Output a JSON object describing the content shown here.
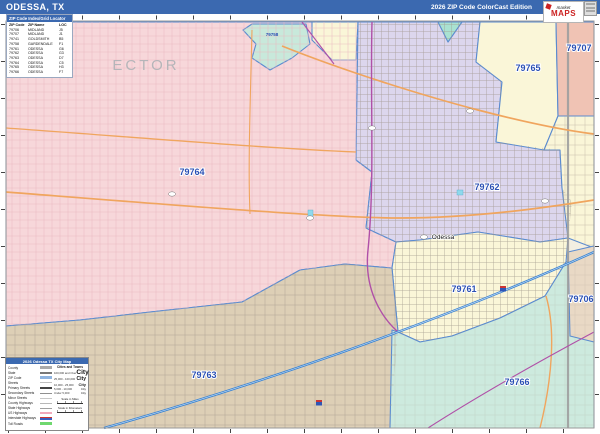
{
  "header": {
    "title": "ODESSA, TX",
    "edition": "2026 ZIP Code ColorCast Edition",
    "brand_top": "market",
    "brand_name": "MAPS"
  },
  "zip_index": {
    "title": "ZIP Code Index/Grid Locator",
    "columns": [
      "ZIP Code",
      "ZIP Name",
      "LOC"
    ],
    "rows": [
      [
        "79706",
        "MIDLAND",
        "J5"
      ],
      [
        "79707",
        "MIDLAND",
        "J1"
      ],
      [
        "79741",
        "GOLDSMITH",
        "B5"
      ],
      [
        "79758",
        "GARDENDALE",
        "F1"
      ],
      [
        "79761",
        "ODESSA",
        "G6"
      ],
      [
        "79762",
        "ODESSA",
        "G3"
      ],
      [
        "79763",
        "ODESSA",
        "D7"
      ],
      [
        "79764",
        "ODESSA",
        "C5"
      ],
      [
        "79765",
        "ODESSA",
        "H3"
      ],
      [
        "79766",
        "ODESSA",
        "F7"
      ]
    ]
  },
  "map": {
    "county_label": "ECTOR",
    "city_label": "Odessa",
    "labels": [
      "79764",
      "79762",
      "79765",
      "79707",
      "79758",
      "79761",
      "79763",
      "79766",
      "79706"
    ],
    "region_colors": {
      "79764": "#f7d7da",
      "79762": "#dcd6ed",
      "79765": "#faf6d8",
      "79707": "#f0c3b4",
      "79758": "#c8e9db",
      "79761": "#faf6d8",
      "79763": "#ddcfb6",
      "79766": "#cdeade",
      "79706": "#e9d9c5",
      "teal_wedge": "#a9e2d1"
    },
    "accent_colors": {
      "zip_label_blue": "#2b50b4",
      "boundary_blue": "#5a8bd0",
      "interstate_blue": "#3f86d2",
      "highway_orange": "#f0a55e",
      "highway_magenta": "#b050a8",
      "county_line_gray": "#9f9f9f"
    }
  },
  "legend": {
    "title": "2026 Odessa TX City Map",
    "left_items": [
      "County",
      "State",
      "ZIP Code",
      "Streets",
      "Primary Streets",
      "Secondary Streets",
      "Minor Streets",
      "County Highways",
      "State Highways",
      "US Highways",
      "Interstate Highways",
      "Toll Roads"
    ],
    "cities_title": "Cities and Towns",
    "city_rows": [
      {
        "range": "100,000 and Over",
        "label": "City"
      },
      {
        "range": "25,000 - 100,000",
        "label": "City"
      },
      {
        "range": "10,000 - 25,000",
        "label": "City"
      },
      {
        "range": "5,000 - 10,000",
        "label": "City"
      },
      {
        "range": "Under 5,000",
        "label": "City"
      }
    ],
    "scale_miles": "Scale in Miles",
    "scale_km": "Scale in Kilometers"
  }
}
